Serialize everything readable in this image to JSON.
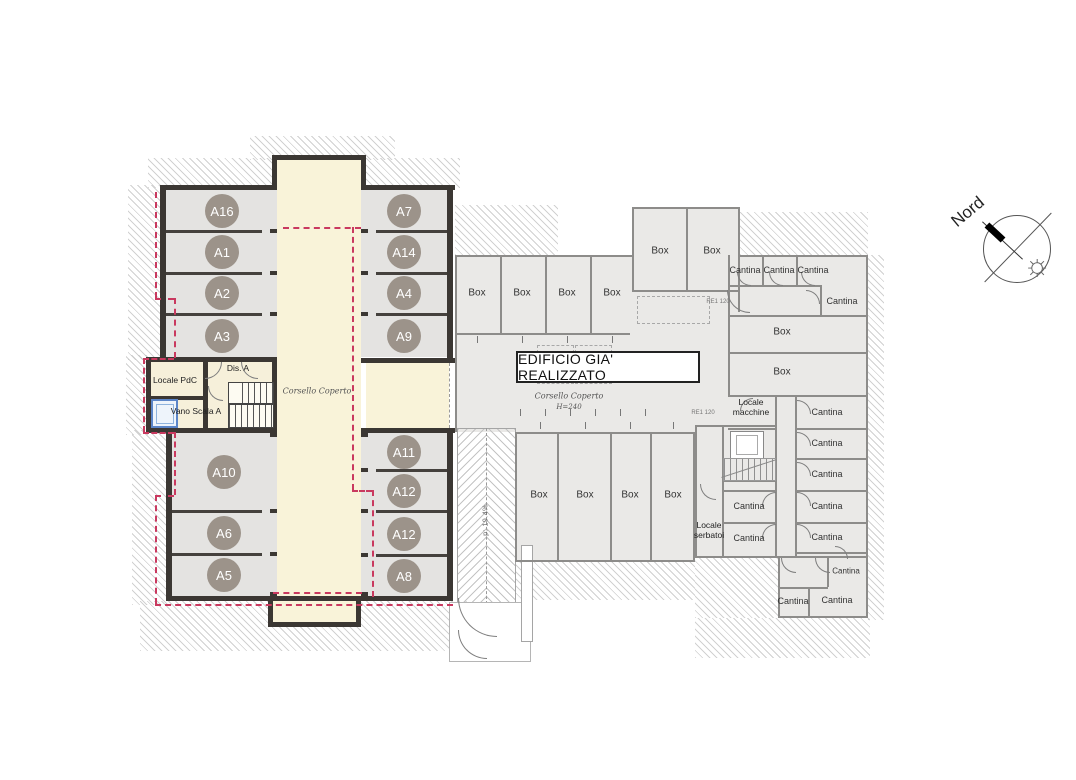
{
  "colors": {
    "wall_dark": "#3b3733",
    "wall_light": "#8d8c8a",
    "corridor_fill": "#f9f3d9",
    "stall_fill": "#e4e3e1",
    "existing_fill": "#eae9e7",
    "stall_badge": "#9c938a",
    "boundary_red": "#c9395f",
    "elevator_blue": "#5b85c8"
  },
  "north": {
    "label": "Nord"
  },
  "icons": {
    "sun": "☼"
  },
  "new_building": {
    "corridor_label": "Corsello Coperto",
    "stalls_top_left": [
      "A16",
      "A1",
      "A2",
      "A3"
    ],
    "stalls_top_right": [
      "A7",
      "A14",
      "A4",
      "A9"
    ],
    "stalls_bottom_left": [
      "A10",
      "A6",
      "A5"
    ],
    "stalls_bottom_right": [
      "A11",
      "A12",
      "A12",
      "A8"
    ],
    "rooms": {
      "locale_pdc": "Locale PdC",
      "dis_a": "Dis. A",
      "vano_scala": "Vano Scala A"
    }
  },
  "existing_building": {
    "banner": "EDIFICIO GIA' REALIZZATO",
    "corridor_label": "Corsello Coperto",
    "corridor_height": "H=240",
    "box_top": [
      "Box",
      "Box",
      "Box",
      "Box"
    ],
    "box_upper": [
      "Box",
      "Box"
    ],
    "box_mid": [
      "Box",
      "Box"
    ],
    "box_bottom": [
      "Box",
      "Box",
      "Box",
      "Box"
    ],
    "cantina_labels": [
      "Cantina",
      "Cantina",
      "Cantina",
      "Cantina",
      "Cantina",
      "Cantina",
      "Cantina",
      "Cantina",
      "Cantina",
      "Cantina",
      "Cantina",
      "Cantina",
      "Cantina",
      "Cantina"
    ],
    "locale_macchine": "Locale macchine",
    "locale_serbatoi": "Locale serbatoi",
    "door_note": "RE1 120"
  },
  "ramp": {
    "slope_label": "p: 19.4%"
  }
}
